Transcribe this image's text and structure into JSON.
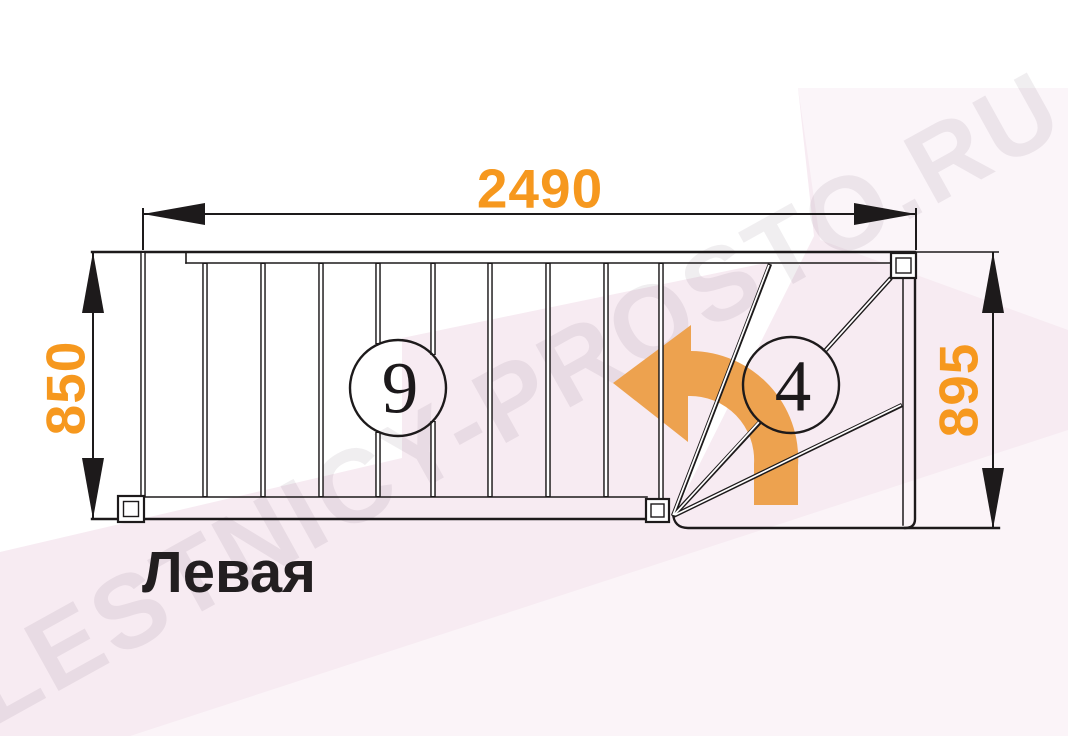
{
  "diagram": {
    "type": "stair-plan-top-view",
    "title": "Левая",
    "watermark": "LESTNICY-PROSTO.RU",
    "dimensions": {
      "top_width": "2490",
      "left_height": "850",
      "right_height": "895"
    },
    "step_counts": {
      "straight_flight": "9",
      "winder_turn": "4"
    },
    "colors": {
      "dimension_text": "#f6981e",
      "turn_arrow": "#eda24f",
      "drawing_line": "#1d1a1b",
      "watermark_band": "#f7ebf2",
      "title_text": "#221e20"
    }
  }
}
